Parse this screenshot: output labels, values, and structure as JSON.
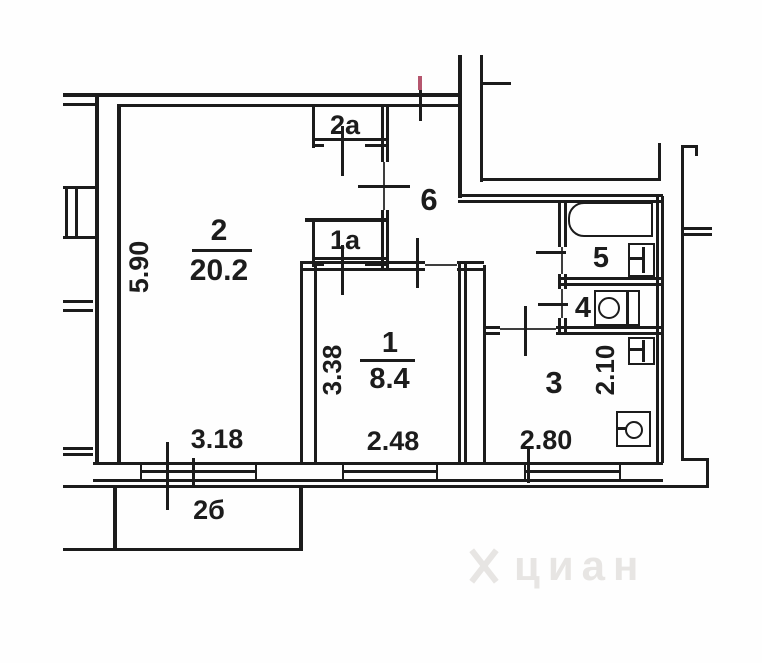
{
  "plan_type": "apartment-floor-plan",
  "rooms": [
    {
      "number": "2",
      "area": "20.2"
    },
    {
      "number": "1",
      "area": "8.4"
    },
    {
      "number": "3"
    },
    {
      "number": "4"
    },
    {
      "number": "5"
    },
    {
      "number": "6"
    },
    {
      "number": "2а"
    },
    {
      "number": "1а"
    },
    {
      "number": "2б"
    }
  ],
  "dimensions": {
    "room2_height": "5.90",
    "room2_width": "3.18",
    "room1_height": "3.38",
    "room1_width": "2.48",
    "room3_height": "2.10",
    "room3_width": "2.80"
  },
  "fixtures": [
    "bathtub",
    "sink",
    "toilet",
    "sink",
    "stove"
  ],
  "watermark": {
    "text": "циан"
  },
  "colors": {
    "line": "#1c1c1c",
    "red_mark": "#b5566e",
    "watermark": "#e7e5e3"
  }
}
